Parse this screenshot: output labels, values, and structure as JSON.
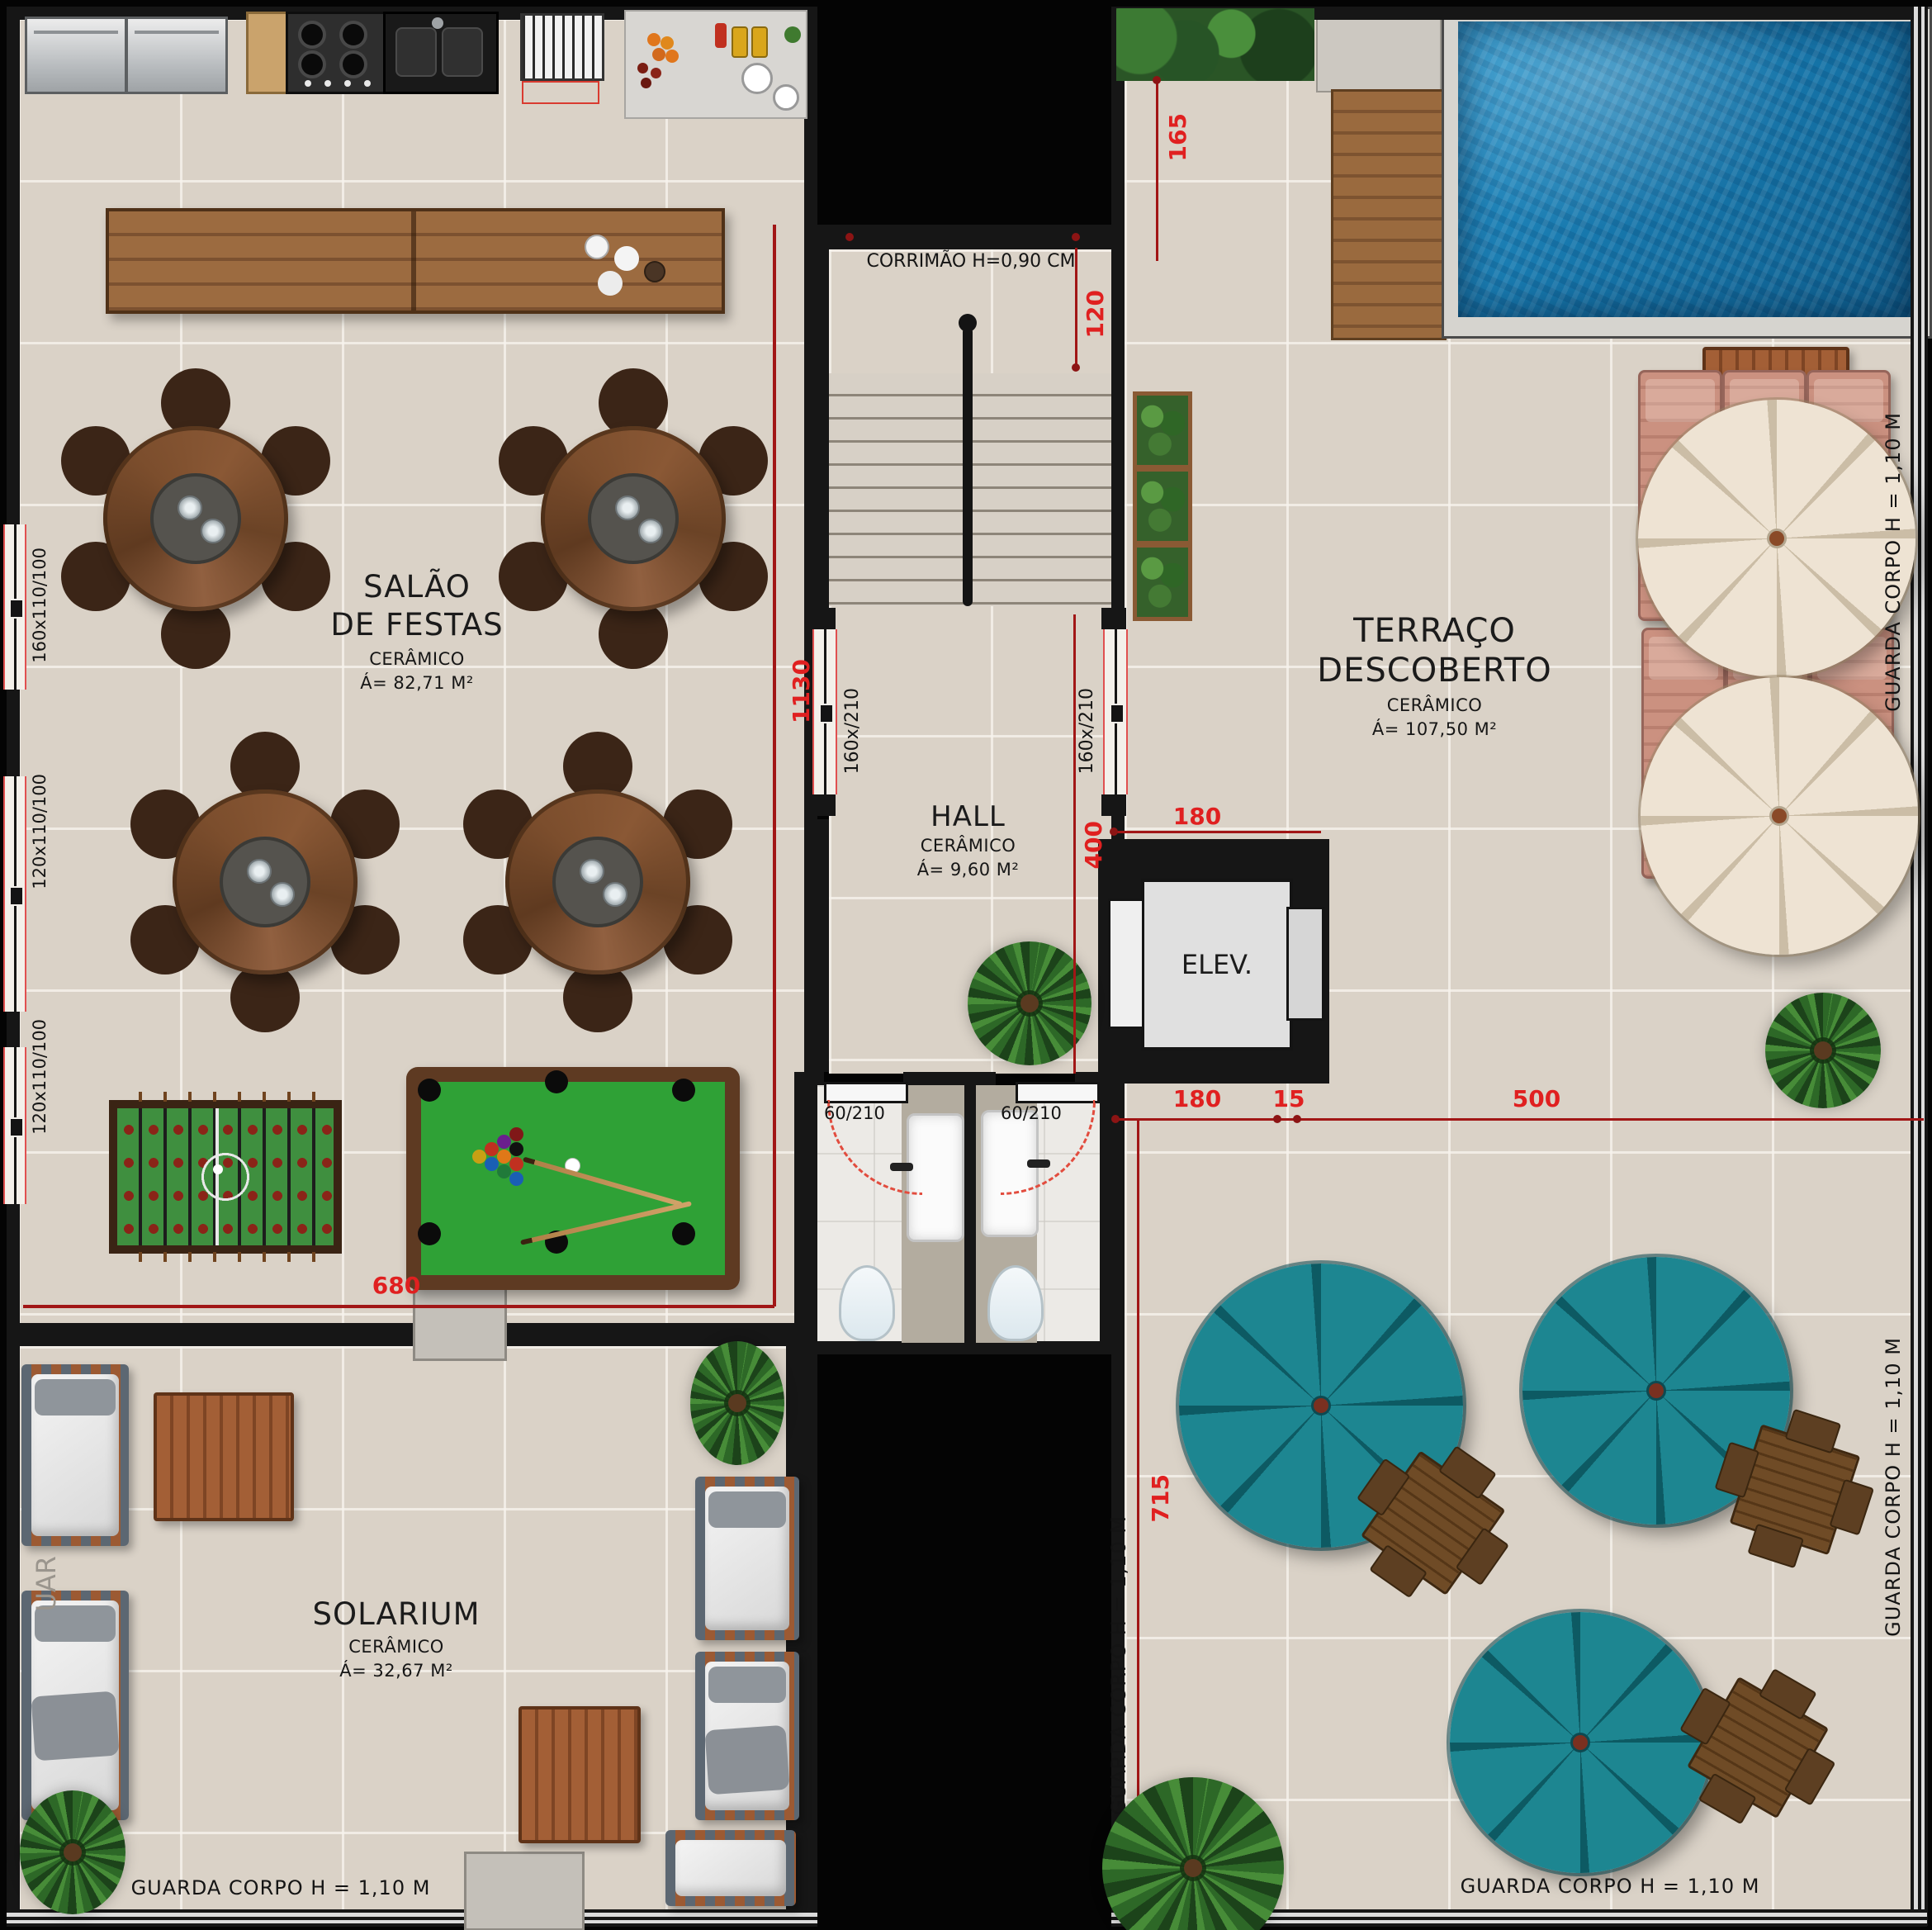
{
  "rooms": {
    "salao": {
      "line1": "SALÃO",
      "line2": "DE FESTAS",
      "material": "CERÂMICO",
      "area": "Á= 82,71 M²"
    },
    "hall": {
      "name": "HALL",
      "material": "CERÂMICO",
      "area": "Á= 9,60 M²"
    },
    "terraco": {
      "line1": "TERRAÇO",
      "line2": "DESCOBERTO",
      "material": "CERÂMICO",
      "area": "Á= 107,50 M²"
    },
    "solarium": {
      "name": "SOLARIUM",
      "material": "CERÂMICO",
      "area": "Á= 32,67 M²"
    },
    "elevator": {
      "label": "ELEV."
    }
  },
  "annotations": {
    "corrimao": "CORRIMÃO H=0,90 CM",
    "guarda_corpo": "GUARDA CORPO H = 1,10 M",
    "guarda_corpo_partial": "UAR"
  },
  "dimensions": {
    "v1130": "1130",
    "h680": "680",
    "v120": "120",
    "v400": "400",
    "h180_elev": "180",
    "v165": "165",
    "h180": "180",
    "h15": "15",
    "h500": "500",
    "v715": "715"
  },
  "openings": {
    "window_160": "160x110/100",
    "window_120a": "120x110/100",
    "window_120b": "120x110/100",
    "door_160_left": "160x/210",
    "door_160_right": "160x/210",
    "door_60_a": "60/210",
    "door_60_b": "60/210"
  },
  "colors": {
    "dim_red": "#e02020",
    "dim_line": "#a11616",
    "wall": "#161616",
    "floor_tile": "#dad2c7",
    "pool_water": "#1778ad",
    "umbrella_teal": "#1d8691",
    "umbrella_beige": "#eee3d3",
    "lounger_salmon": "#c98d7c",
    "felt_green": "#2fa136"
  }
}
